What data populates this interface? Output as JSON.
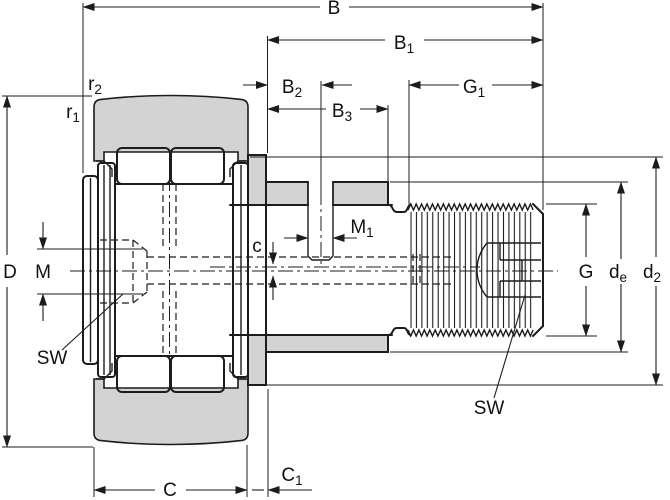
{
  "drawing": {
    "type": "bearing-cross-section-dimension-drawing",
    "colors": {
      "line": "#1c1c1c",
      "section_fill": "#d3d3d3",
      "background": "#ffffff"
    },
    "labels": {
      "B": {
        "base": "B",
        "sub": ""
      },
      "B1": {
        "base": "B",
        "sub": "1"
      },
      "B2": {
        "base": "B",
        "sub": "2"
      },
      "B3": {
        "base": "B",
        "sub": "3"
      },
      "G1": {
        "base": "G",
        "sub": "1"
      },
      "r2": {
        "base": "r",
        "sub": "2"
      },
      "r1": {
        "base": "r",
        "sub": "1"
      },
      "D": {
        "base": "D",
        "sub": ""
      },
      "M": {
        "base": "M",
        "sub": ""
      },
      "SW_left": {
        "base": "SW",
        "sub": ""
      },
      "c": {
        "base": "c",
        "sub": ""
      },
      "M1": {
        "base": "M",
        "sub": "1"
      },
      "G": {
        "base": "G",
        "sub": ""
      },
      "de": {
        "base": "d",
        "sub": "e"
      },
      "d2": {
        "base": "d",
        "sub": "2"
      },
      "SW_right": {
        "base": "SW",
        "sub": ""
      },
      "C": {
        "base": "C",
        "sub": ""
      },
      "C1": {
        "base": "C",
        "sub": "1"
      }
    }
  }
}
